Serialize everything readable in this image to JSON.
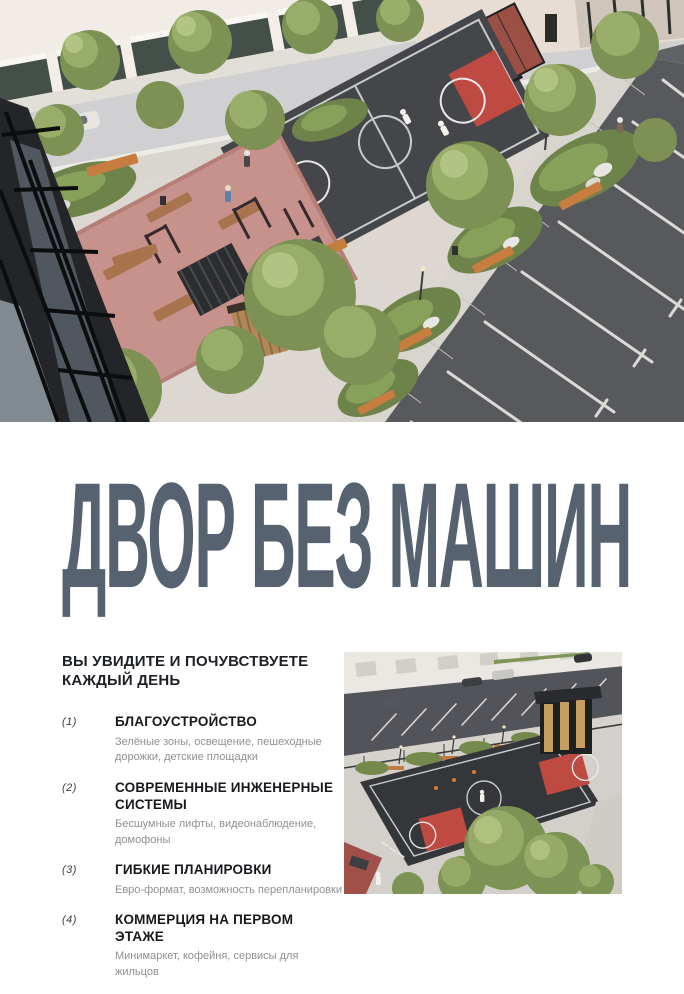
{
  "theme": {
    "headline": "#566270",
    "court-red": "#bf4a42",
    "court-dark": "#45464a",
    "bench-wood": "#c77c40",
    "asphalt": "#58595d"
  },
  "hero": {
    "name": "aerial-courtyard-render",
    "court_label": "BASKETBALL"
  },
  "headline": {
    "text": "ДВОР БЕЗ МАШИН"
  },
  "features": {
    "heading_line1": "ВЫ УВИДИТЕ И ПОЧУВСТВУЕТЕ",
    "heading_line2": "КАЖДЫЙ ДЕНЬ",
    "items": [
      {
        "num": "(1)",
        "title": "БЛАГОУСТРОЙСТВО",
        "desc": "Зелёные зоны, освещение, пешеходные дорожки, детские площадки"
      },
      {
        "num": "(2)",
        "title": "СОВРЕМЕННЫЕ ИНЖЕНЕРНЫЕ СИСТЕМЫ",
        "desc": "Бесшумные лифты, видеонаблюдение, домофоны"
      },
      {
        "num": "(3)",
        "title": "ГИБКИЕ ПЛАНИРОВКИ",
        "desc": "Евро-формат, возможность перепланировки"
      },
      {
        "num": "(4)",
        "title": "КОММЕРЦИЯ НА ПЕРВОМ ЭТАЖЕ",
        "desc": "Минимаркет, кофейня, сервисы для жильцов"
      }
    ]
  },
  "secondary_image": {
    "name": "courtyard-basketball-render"
  }
}
